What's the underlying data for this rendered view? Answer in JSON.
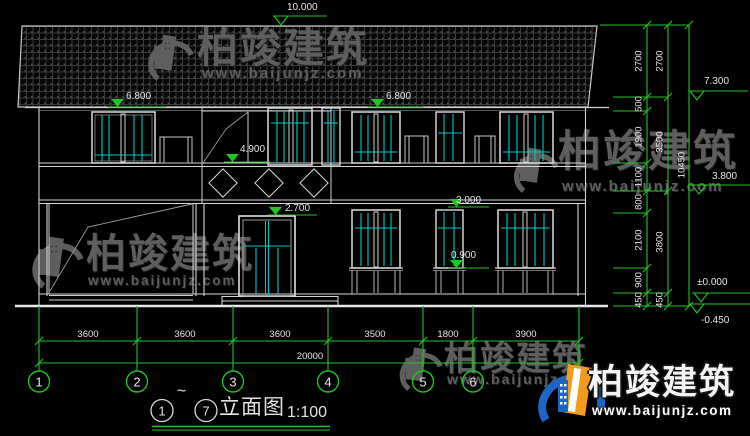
{
  "brand": {
    "name": "柏竣建筑",
    "url": "www.baijunjz.com"
  },
  "title": {
    "circle_start": "1",
    "tilde": "~",
    "circle_end": "7",
    "text": "立面图",
    "scale": "1:100"
  },
  "levels": {
    "ridge": "10.000",
    "eave_left": "6.800",
    "eave_right": "6.800",
    "parapet": "4.900",
    "door_head": "2.700",
    "window_head": "3.000",
    "window_sill": "0.900",
    "right_eave": "7.300",
    "second_floor": "3.800",
    "ground": "±0.000",
    "below_ground": "-0.450"
  },
  "dims": {
    "bottom": [
      "3600",
      "3600",
      "3600",
      "3500",
      "1800",
      "3900"
    ],
    "total": "20000",
    "right_inner": [
      "2700",
      "500",
      "1900",
      "1100",
      "800",
      "2100",
      "900",
      "450"
    ],
    "right_middle": [
      "2700",
      "3500",
      "3800",
      "450"
    ],
    "right_total": "10450"
  },
  "grid": {
    "bubbles": [
      "1",
      "2",
      "3",
      "4",
      "5",
      "6",
      "7"
    ]
  }
}
